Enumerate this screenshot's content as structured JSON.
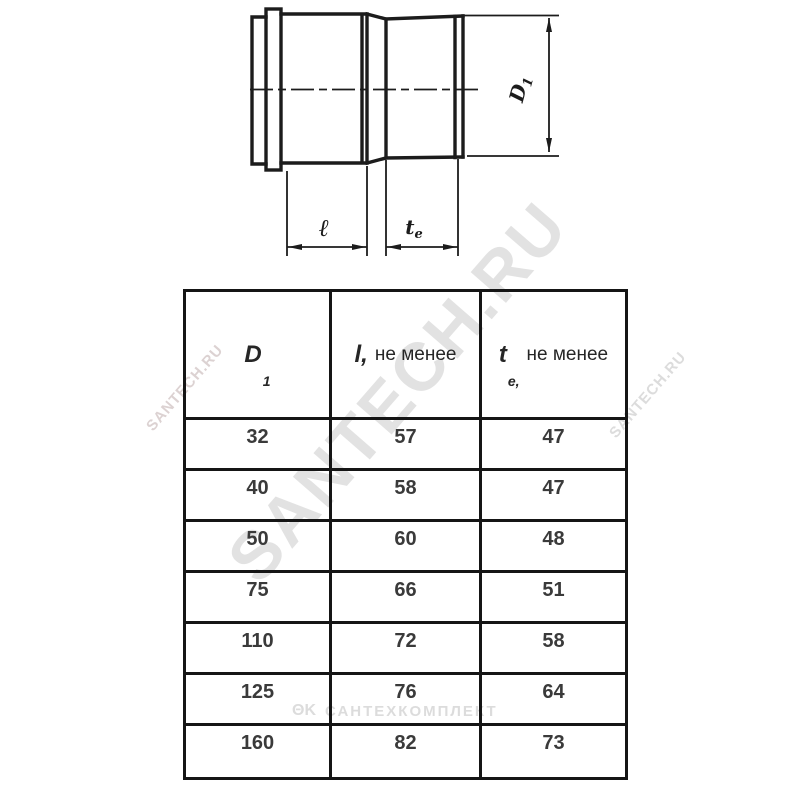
{
  "drawing": {
    "label_l": "ℓ",
    "label_te_sym": "t",
    "label_te_sub": "e",
    "label_d1_sym": "D",
    "label_d1_sub": "1"
  },
  "table": {
    "columns": [
      {
        "sym": "D",
        "sub": "1",
        "rest": ""
      },
      {
        "sym": "l,",
        "sub": "",
        "rest": "не менее"
      },
      {
        "sym": "t",
        "sub": "e,",
        "rest": "не менее"
      }
    ],
    "rows": [
      [
        "32",
        "57",
        "47"
      ],
      [
        "40",
        "58",
        "47"
      ],
      [
        "50",
        "60",
        "48"
      ],
      [
        "75",
        "66",
        "51"
      ],
      [
        "110",
        "72",
        "58"
      ],
      [
        "125",
        "76",
        "64"
      ],
      [
        "160",
        "82",
        "73"
      ]
    ]
  },
  "watermarks": {
    "diagonal": "SANTECH.RU",
    "left_fragment": "SANTECH.RU",
    "right_fragment": "SANTECH.RU",
    "logo": "ΘΚ",
    "company": "САНТЕХКОМПЛЕКТ"
  },
  "colors": {
    "line": "#1c1c1c",
    "table_border": "#151515",
    "text": "#3a3a3a",
    "watermark": "#e2e2e2"
  }
}
